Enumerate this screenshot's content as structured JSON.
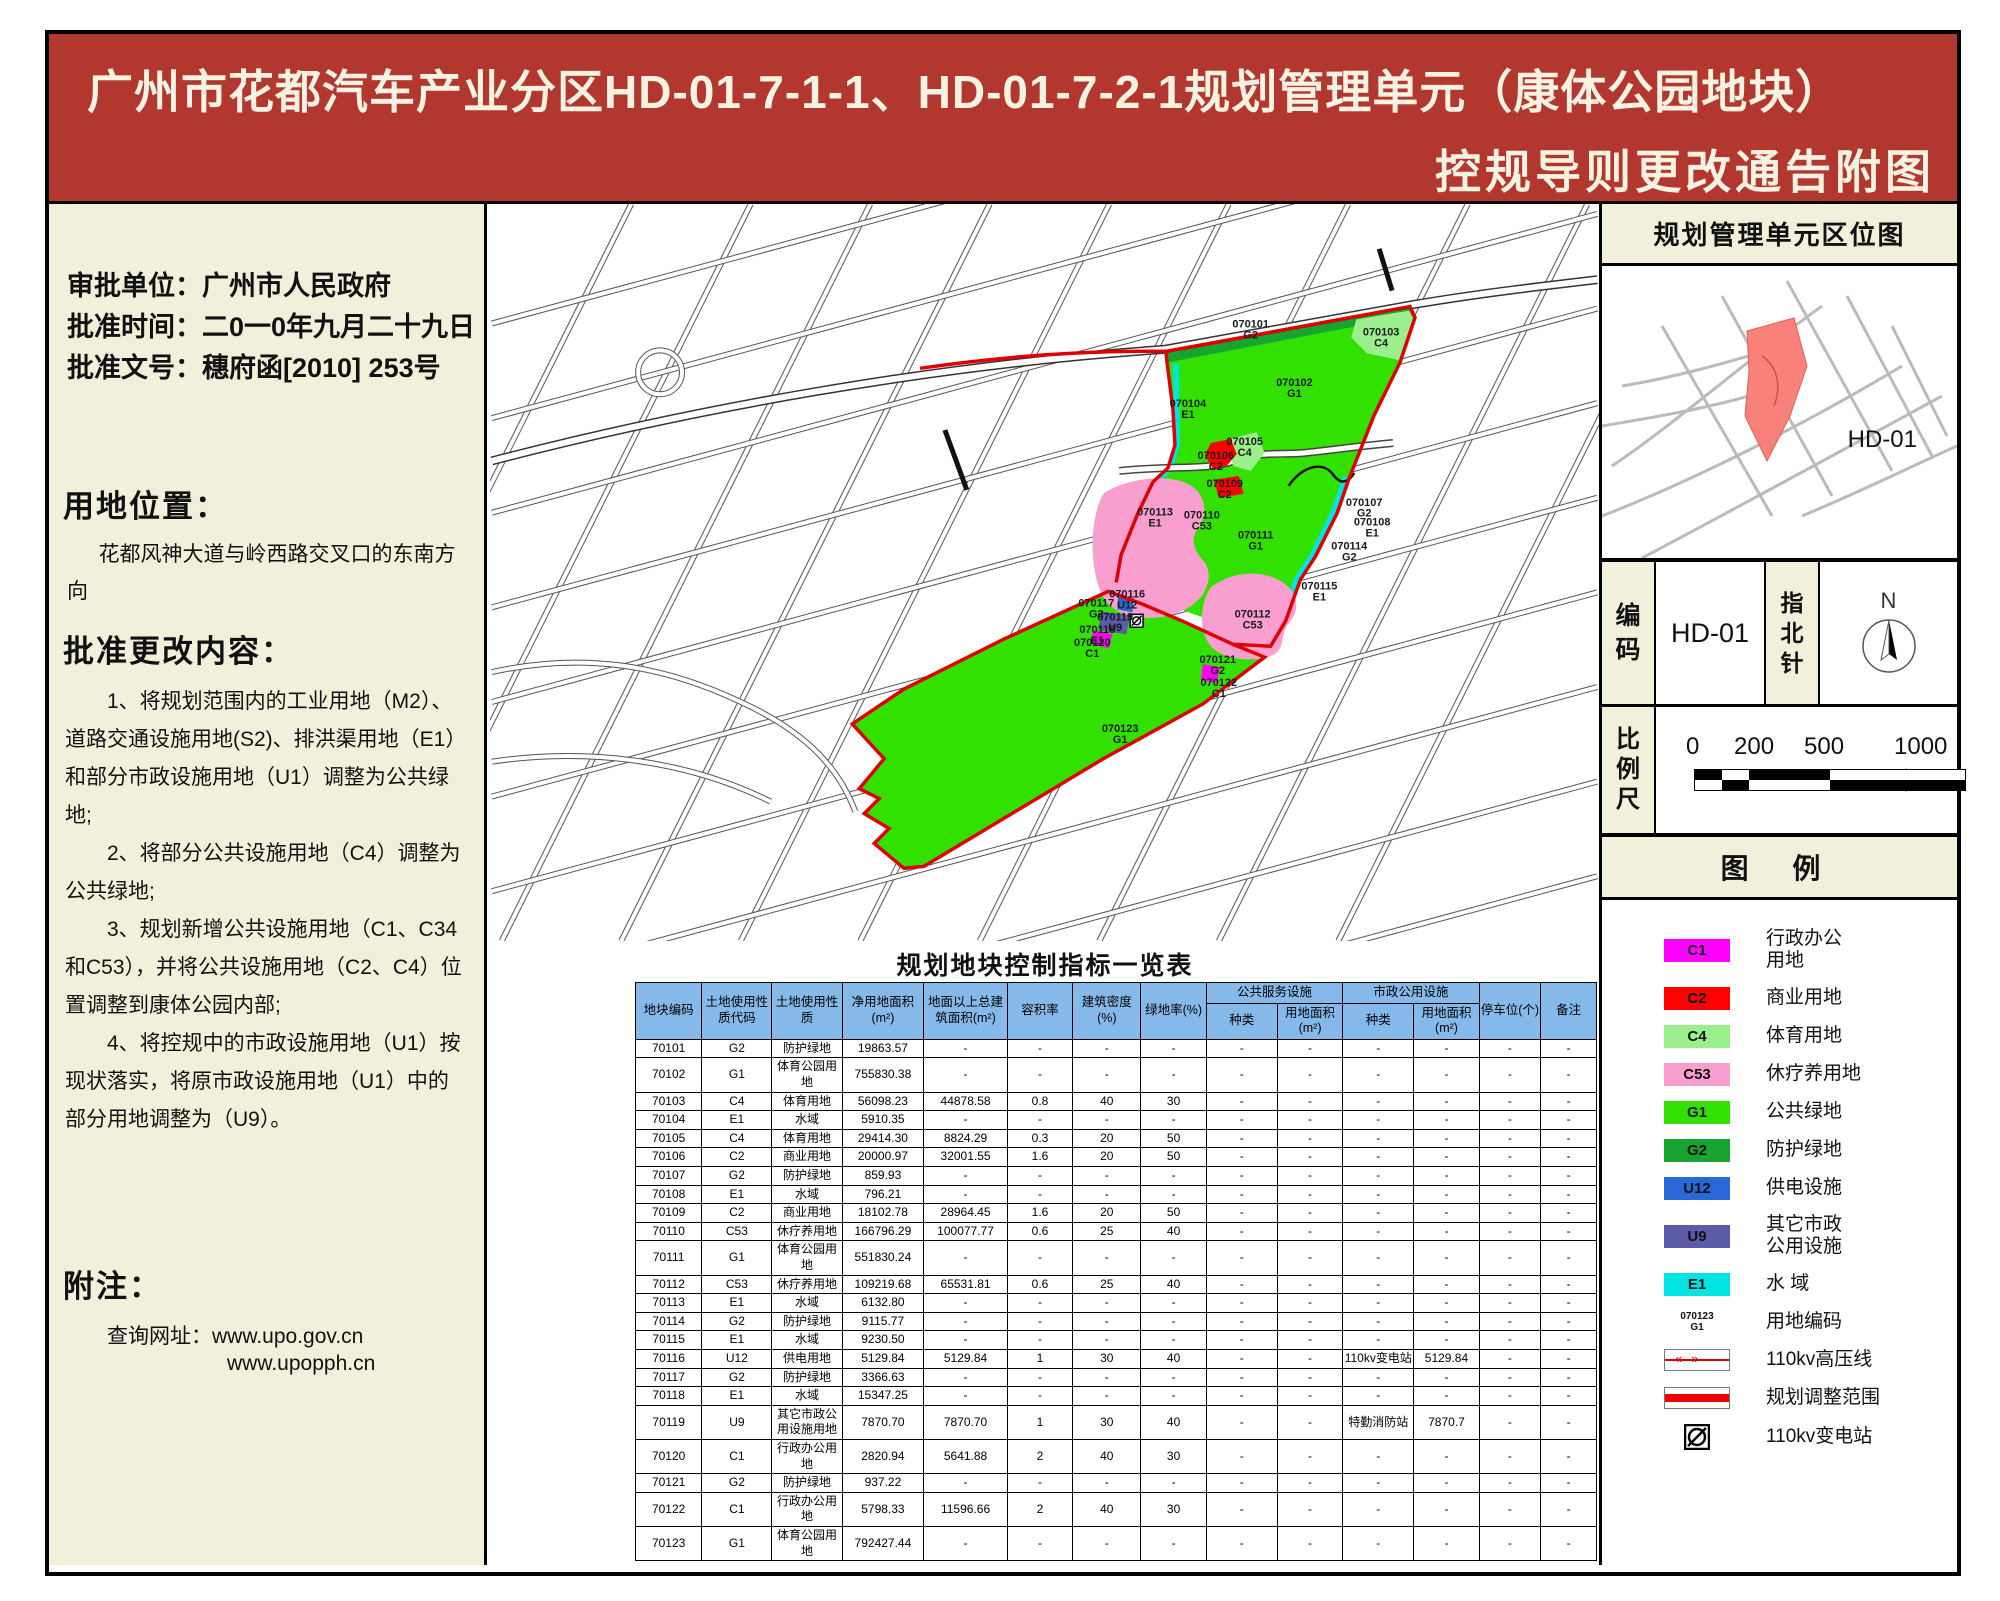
{
  "banner": {
    "title_line1": "广州市花都汽车产业分区HD-01-7-1-1、HD-01-7-2-1规划管理单元（康体公园地块）",
    "title_line2": "控规导则更改通告附图"
  },
  "left_panel": {
    "approval_line1": "审批单位：广州市人民政府",
    "approval_line2": "批准时间：二0一0年九月二十九日",
    "approval_line3": "批准文号：穗府函[2010] 253号",
    "location_heading": "用地位置：",
    "location_text": "花都风神大道与岭西路交叉口的东南方向",
    "changes_heading": "批准更改内容：",
    "changes": [
      "1、将规划范围内的工业用地（M2）、道路交通设施用地(S2)、排洪渠用地（E1）和部分市政设施用地（U1）调整为公共绿地;",
      "2、将部分公共设施用地（C4）调整为公共绿地;",
      "3、规划新增公共设施用地（C1、C34和C53），并将公共设施用地（C2、C4）位置调整到康体公园内部;",
      "4、将控规中的市政设施用地（U1）按现状落实，将原市政设施用地（U1）中的部分用地调整为（U9）。"
    ],
    "notes_heading": "附注：",
    "notes_label": "查询网址：www.upo.gov.cn",
    "notes_url2": "www.upopph.cn"
  },
  "map": {
    "parcels": [
      {
        "code": "070101",
        "cls": "G2",
        "x": 762,
        "y": 124
      },
      {
        "code": "070102",
        "cls": "G1",
        "x": 806,
        "y": 183
      },
      {
        "code": "070103",
        "cls": "C4",
        "x": 893,
        "y": 132
      },
      {
        "code": "070104",
        "cls": "E1",
        "x": 699,
        "y": 204
      },
      {
        "code": "070105",
        "cls": "C4",
        "x": 756,
        "y": 242
      },
      {
        "code": "070106",
        "cls": "C2",
        "x": 727,
        "y": 256
      },
      {
        "code": "070109",
        "cls": "C2",
        "x": 736,
        "y": 284
      },
      {
        "code": "070110",
        "cls": "C53",
        "x": 713,
        "y": 316
      },
      {
        "code": "070111",
        "cls": "G1",
        "x": 767,
        "y": 336
      },
      {
        "code": "070112",
        "cls": "C53",
        "x": 764,
        "y": 415
      },
      {
        "code": "070113",
        "cls": "E1",
        "x": 666,
        "y": 313
      },
      {
        "code": "070107",
        "cls": "G2",
        "x": 876,
        "y": 303
      },
      {
        "code": "070108",
        "cls": "E1",
        "x": 884,
        "y": 323
      },
      {
        "code": "070114",
        "cls": "G2",
        "x": 861,
        "y": 347
      },
      {
        "code": "070115",
        "cls": "E1",
        "x": 831,
        "y": 387
      },
      {
        "code": "070116",
        "cls": "U12",
        "x": 638,
        "y": 395
      },
      {
        "code": "070117",
        "cls": "G2",
        "x": 607,
        "y": 404
      },
      {
        "code": "070119",
        "cls": "U9",
        "x": 626,
        "y": 418
      },
      {
        "code": "070118",
        "cls": "E1",
        "x": 608,
        "y": 431
      },
      {
        "code": "070120",
        "cls": "C1",
        "x": 603,
        "y": 444
      },
      {
        "code": "070121",
        "cls": "G2",
        "x": 729,
        "y": 461
      },
      {
        "code": "070122",
        "cls": "C1",
        "x": 730,
        "y": 484
      },
      {
        "code": "070123",
        "cls": "G1",
        "x": 631,
        "y": 530
      }
    ]
  },
  "table": {
    "title": "规划地块控制指标一览表",
    "col_headers": [
      {
        "label": "地块编码"
      },
      {
        "label": "土地使用性质代码"
      },
      {
        "label": "土地使用性质"
      },
      {
        "label": "净用地面积(m²)"
      },
      {
        "label": "地面以上总建筑面积(m²)"
      },
      {
        "label": "容积率"
      },
      {
        "label": "建筑密度(%)"
      },
      {
        "label": "绿地率(%)"
      },
      {
        "label": "公共服务设施",
        "colspan": 2,
        "children": [
          "种类",
          "用地面积(m²)"
        ]
      },
      {
        "label": "市政公用设施",
        "colspan": 2,
        "children": [
          "种类",
          "用地面积(m²)"
        ]
      },
      {
        "label": "停车位(个)"
      },
      {
        "label": "备注"
      }
    ],
    "rows": [
      [
        "70101",
        "G2",
        "防护绿地",
        "19863.57",
        "-",
        "-",
        "-",
        "-",
        "-",
        "-",
        "-",
        "-",
        "-",
        "-"
      ],
      [
        "70102",
        "G1",
        "体育公园用地",
        "755830.38",
        "-",
        "-",
        "-",
        "-",
        "-",
        "-",
        "-",
        "-",
        "-",
        "-"
      ],
      [
        "70103",
        "C4",
        "体育用地",
        "56098.23",
        "44878.58",
        "0.8",
        "40",
        "30",
        "-",
        "-",
        "-",
        "-",
        "-",
        "-"
      ],
      [
        "70104",
        "E1",
        "水域",
        "5910.35",
        "-",
        "-",
        "-",
        "-",
        "-",
        "-",
        "-",
        "-",
        "-",
        "-"
      ],
      [
        "70105",
        "C4",
        "体育用地",
        "29414.30",
        "8824.29",
        "0.3",
        "20",
        "50",
        "-",
        "-",
        "-",
        "-",
        "-",
        "-"
      ],
      [
        "70106",
        "C2",
        "商业用地",
        "20000.97",
        "32001.55",
        "1.6",
        "20",
        "50",
        "-",
        "-",
        "-",
        "-",
        "-",
        "-"
      ],
      [
        "70107",
        "G2",
        "防护绿地",
        "859.93",
        "-",
        "-",
        "-",
        "-",
        "-",
        "-",
        "-",
        "-",
        "-",
        "-"
      ],
      [
        "70108",
        "E1",
        "水域",
        "796.21",
        "-",
        "-",
        "-",
        "-",
        "-",
        "-",
        "-",
        "-",
        "-",
        "-"
      ],
      [
        "70109",
        "C2",
        "商业用地",
        "18102.78",
        "28964.45",
        "1.6",
        "20",
        "50",
        "-",
        "-",
        "-",
        "-",
        "-",
        "-"
      ],
      [
        "70110",
        "C53",
        "休疗养用地",
        "166796.29",
        "100077.77",
        "0.6",
        "25",
        "40",
        "-",
        "-",
        "-",
        "-",
        "-",
        "-"
      ],
      [
        "70111",
        "G1",
        "体育公园用地",
        "551830.24",
        "-",
        "-",
        "-",
        "-",
        "-",
        "-",
        "-",
        "-",
        "-",
        "-"
      ],
      [
        "70112",
        "C53",
        "休疗养用地",
        "109219.68",
        "65531.81",
        "0.6",
        "25",
        "40",
        "-",
        "-",
        "-",
        "-",
        "-",
        "-"
      ],
      [
        "70113",
        "E1",
        "水域",
        "6132.80",
        "-",
        "-",
        "-",
        "-",
        "-",
        "-",
        "-",
        "-",
        "-",
        "-"
      ],
      [
        "70114",
        "G2",
        "防护绿地",
        "9115.77",
        "-",
        "-",
        "-",
        "-",
        "-",
        "-",
        "-",
        "-",
        "-",
        "-"
      ],
      [
        "70115",
        "E1",
        "水域",
        "9230.50",
        "-",
        "-",
        "-",
        "-",
        "-",
        "-",
        "-",
        "-",
        "-",
        "-"
      ],
      [
        "70116",
        "U12",
        "供电用地",
        "5129.84",
        "5129.84",
        "1",
        "30",
        "40",
        "-",
        "-",
        "110kv变电站",
        "5129.84",
        "-",
        "-"
      ],
      [
        "70117",
        "G2",
        "防护绿地",
        "3366.63",
        "-",
        "-",
        "-",
        "-",
        "-",
        "-",
        "-",
        "-",
        "-",
        "-"
      ],
      [
        "70118",
        "E1",
        "水域",
        "15347.25",
        "-",
        "-",
        "-",
        "-",
        "-",
        "-",
        "-",
        "-",
        "-",
        "-"
      ],
      [
        "70119",
        "U9",
        "其它市政公用设施用地",
        "7870.70",
        "7870.70",
        "1",
        "30",
        "40",
        "-",
        "-",
        "特勤消防站",
        "7870.7",
        "-",
        "-"
      ],
      [
        "70120",
        "C1",
        "行政办公用地",
        "2820.94",
        "5641.88",
        "2",
        "40",
        "30",
        "-",
        "-",
        "-",
        "-",
        "-",
        "-"
      ],
      [
        "70121",
        "G2",
        "防护绿地",
        "937.22",
        "-",
        "-",
        "-",
        "-",
        "-",
        "-",
        "-",
        "-",
        "-",
        "-"
      ],
      [
        "70122",
        "C1",
        "行政办公用地",
        "5798.33",
        "11596.66",
        "2",
        "40",
        "30",
        "-",
        "-",
        "-",
        "-",
        "-",
        "-"
      ],
      [
        "70123",
        "G1",
        "体育公园用地",
        "792427.44",
        "-",
        "-",
        "-",
        "-",
        "-",
        "-",
        "-",
        "-",
        "-",
        "-"
      ]
    ]
  },
  "right_panel": {
    "location_map_title": "规划管理单元区位图",
    "location_map_label": "HD-01",
    "code_label_1": "编",
    "code_label_2": "码",
    "code_value": "HD-01",
    "north_label_1": "指",
    "north_label_2": "北",
    "north_label_3": "针",
    "north_n": "N",
    "scale_label_1": "比",
    "scale_label_2": "例",
    "scale_label_3": "尺",
    "scale_ticks": [
      "0",
      "200",
      "500",
      "1000米"
    ],
    "legend_title": "图  例",
    "legend_items": [
      {
        "code": "C1",
        "color": "#ff00ff",
        "label": "行政办公\n用地"
      },
      {
        "code": "C2",
        "color": "#ff0000",
        "label": "商业用地"
      },
      {
        "code": "C4",
        "color": "#9cef8d",
        "label": "体育用地"
      },
      {
        "code": "C53",
        "color": "#f89fcf",
        "label": "休疗养用地"
      },
      {
        "code": "G1",
        "color": "#33e100",
        "label": "公共绿地"
      },
      {
        "code": "G2",
        "color": "#18a431",
        "label": "防护绿地"
      },
      {
        "code": "U12",
        "color": "#2968d8",
        "label": "供电设施"
      },
      {
        "code": "U9",
        "color": "#5b5ba8",
        "label": "其它市政\n公用设施"
      },
      {
        "code": "E1",
        "color": "#00e4e4",
        "label": "水      域"
      }
    ],
    "legend_extras": [
      {
        "type": "code-sample",
        "sample1": "070123",
        "sample2": "G1",
        "label": "用地编码"
      },
      {
        "type": "hv-line",
        "label": "110kv高压线"
      },
      {
        "type": "adjust-range",
        "label": "规划调整范围"
      },
      {
        "type": "substation",
        "label": "110kv变电站"
      }
    ]
  },
  "colors": {
    "banner_bg": "#b2382f",
    "panel_cream": "#f2efda",
    "table_header_blue": "#85b9ea",
    "boundary_red": "#e00000",
    "minimap_highlight": "#f8827a",
    "G1": "#33e100",
    "G2": "#18a431",
    "C4": "#9cef8d",
    "C53": "#f89fcf",
    "C1": "#ff00ff",
    "C2": "#ff0000",
    "U12": "#2968d8",
    "U9": "#5b5ba8",
    "E1": "#00e4e4"
  }
}
